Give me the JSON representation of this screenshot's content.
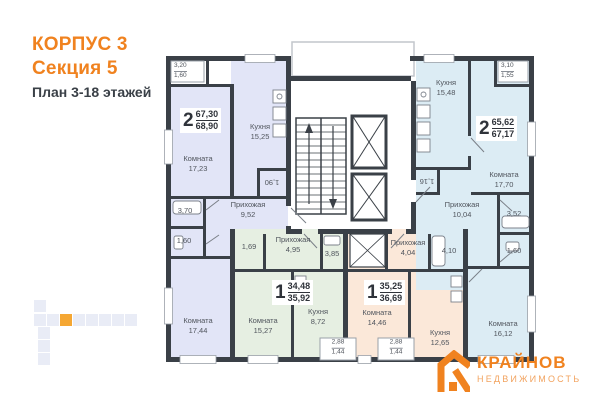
{
  "header": {
    "building": "КОРПУС 3",
    "section": "Секция 5",
    "floors": "План 3-18 этажей"
  },
  "apartments": {
    "left": {
      "number": "2",
      "area_main": "67,30",
      "area_total": "68,90",
      "kitchen": {
        "name": "Кухня",
        "area": "15,25"
      },
      "room1": {
        "name": "Комната",
        "area": "17,23"
      },
      "room2": {
        "name": "Комната",
        "area": "17,44"
      },
      "hall": {
        "name": "Прихожая",
        "area": "9,52"
      },
      "bath": {
        "area": "3,70"
      },
      "wc": {
        "area": "1,60"
      },
      "pantry": {
        "area": "1,90"
      },
      "balcony": {
        "area_full": "3,20",
        "area_reduced": "1,60"
      }
    },
    "green": {
      "number": "1",
      "area_main": "34,48",
      "area_total": "35,92",
      "room": {
        "name": "Комната",
        "area": "15,27"
      },
      "kitchen": {
        "name": "Кухня",
        "area": "8,72"
      },
      "hall": {
        "name": "Прихожая",
        "area": "4,95"
      },
      "bath": {
        "area": "3,85"
      },
      "storage": {
        "area": "1,69"
      },
      "balcony": {
        "area_full": "2,88",
        "area_reduced": "1,44"
      }
    },
    "peach": {
      "number": "1",
      "area_main": "35,25",
      "area_total": "36,69",
      "room": {
        "name": "Комната",
        "area": "14,46"
      },
      "kitchen": {
        "name": "Кухня",
        "area": "12,65"
      },
      "hall": {
        "name": "Прихожая",
        "area": "4,04"
      },
      "bath": {
        "area": "4,10"
      },
      "balcony": {
        "area_full": "2,88",
        "area_reduced": "1,44"
      }
    },
    "right": {
      "number": "2",
      "area_main": "65,62",
      "area_total": "67,17",
      "kitchen": {
        "name": "Кухня",
        "area": "15,48"
      },
      "room1": {
        "name": "Комната",
        "area": "17,70"
      },
      "room2": {
        "name": "Комната",
        "area": "16,12"
      },
      "hall": {
        "name": "Прихожая",
        "area": "10,04"
      },
      "bath": {
        "area": "3,52"
      },
      "wc": {
        "area": "1,60"
      },
      "storage": {
        "area": "1,16"
      },
      "balcony": {
        "area_full": "3,10",
        "area_reduced": "1,55"
      }
    }
  },
  "logo": {
    "company": "КРАЙНОВ",
    "tagline": "НЕДВИЖИМОСТЬ"
  },
  "colors": {
    "accent_orange": "#F0821F",
    "wall": "#3A4047",
    "apt_left": "#E2E5F7",
    "apt_green": "#E6EFE2",
    "apt_peach": "#FBE8D9",
    "apt_right": "#DCECF4"
  }
}
